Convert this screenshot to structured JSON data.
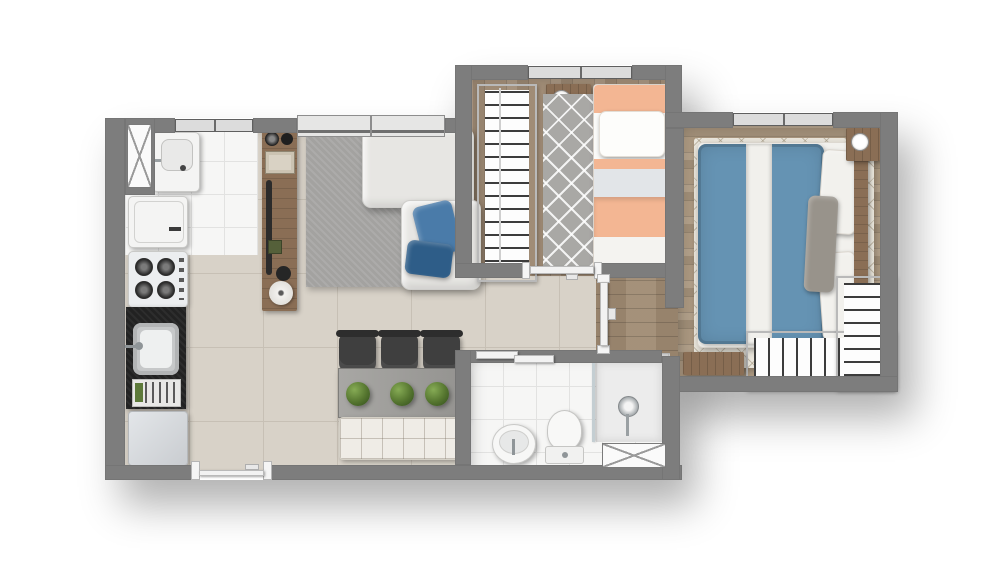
{
  "title": "Apartment floor plan — 2 bedrooms, top-down render, no text labels",
  "colors": {
    "bg": "#ffffff",
    "wall": "#7d7d7d",
    "tile-living": "#d8d2c8",
    "grout-living": "#c7c0b5",
    "tile-service": "#f6f6f5",
    "grout-service": "#e2e2e1",
    "wood-b1": "#a08c76",
    "wood-b2": "#ab9880",
    "wood-hall": "#9f8a72",
    "furniture-wood": "#8a6e55",
    "counter-dark": "#222222",
    "sofa": "#e7e6e3",
    "rug-living": "#a3a2a0",
    "rug-b1": "#a9a8a5",
    "rug-b2": "#eae6dc",
    "bed-peach": "#f3b693",
    "bed-white": "#fafaf8",
    "duvet-blue": "#6593b3",
    "pillow-blue": "#4a7ba9",
    "pillow-navy": "#2e5d88",
    "pillow-gray": "#98938b",
    "plant-green": "#55752f",
    "door-white": "#f2f2f2",
    "glass": "#dcdcdc",
    "chair-dark": "#3f3f3f",
    "bench": "#efece6"
  },
  "rooms": [
    {
      "name": "kitchen-laundry",
      "floor": "white-tile",
      "furniture": [
        "laundry-sink",
        "washing-machine",
        "gas-cooktop",
        "dark-counter",
        "kitchen-sink",
        "dish-rack",
        "refrigerator"
      ]
    },
    {
      "name": "living-dining",
      "floor": "beige-tile",
      "furniture": [
        "area-rug",
        "sectional-sofa",
        "blue-throw-pillows",
        "wood-sideboard",
        "dining-table",
        "three-chairs",
        "three-potted-plants",
        "tufted-bench"
      ]
    },
    {
      "name": "bedroom-1",
      "floor": "wood-plank",
      "furniture": [
        "open-wardrobe-with-clothes",
        "nightstand-with-clock-and-lamp",
        "single-bed-peach-striped",
        "chevron-runner-rug"
      ]
    },
    {
      "name": "bedroom-2",
      "floor": "wood-plank",
      "furniture": [
        "double-bed-blue-duvet",
        "white-pillows",
        "gray-pillow",
        "wood-headboard",
        "nightstand-with-clock",
        "l-shaped-closet-with-clothes",
        "wood-dresser",
        "wall-tv",
        "diamond-pattern-rug"
      ]
    },
    {
      "name": "hallway",
      "floor": "wood-plank",
      "furniture": []
    },
    {
      "name": "bathroom",
      "floor": "white-tile",
      "furniture": [
        "round-washbasin",
        "toilet",
        "shower-with-glass-partition",
        "shower-head"
      ]
    }
  ],
  "openings": {
    "windows": [
      "laundry-side-hatched-window",
      "kitchen-top-window",
      "living-room-window",
      "bedroom1-window",
      "bedroom2-window",
      "bathroom-hatched-window"
    ],
    "doors": [
      "entry-door",
      "bedroom1-door",
      "hallway-door",
      "bathroom-sliding-door",
      "bedroom2-doorway"
    ]
  }
}
